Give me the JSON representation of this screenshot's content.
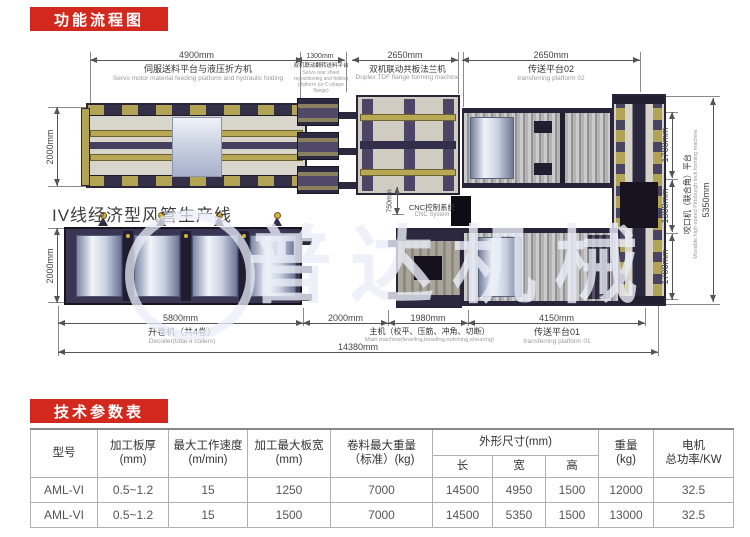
{
  "badges": {
    "flow_title": "功能流程图",
    "params_title": "技术参数表"
  },
  "colors": {
    "badge_red": "#d2281e"
  },
  "diagram": {
    "production_line_title": "IV线经济型风管生产线",
    "watermark_text": "普达机械",
    "cnc_label_zh": "CNC控制系统",
    "cnc_label_en": "CNC System",
    "dims": {
      "top_4900": "4900mm",
      "top_1300": "1300mm",
      "top_2650_a": "2650mm",
      "top_2650_b": "2650mm",
      "left_top": "2000mm",
      "left_bottom": "2000mm",
      "right_1700_a": "1700mm",
      "right_1300": "1300mm",
      "right_1700_b": "1700mm",
      "right_total": "5350mm",
      "cnc_750": "750mm",
      "bottom_5800": "5800mm",
      "bottom_2000": "2000mm",
      "bottom_1980": "1980mm",
      "bottom_4150": "4150mm",
      "bottom_total": "14380mm"
    },
    "labels": {
      "feeding_zh": "伺服送料平台与液压折方机",
      "feeding_en": "Servo motor material feeding platform and hydraulic folding",
      "turnover_zh": "双机联动翻转送料平台",
      "turnover_en": "Servo rear sheet repositioning and folding platform (or C-shape flange)",
      "tdf_zh": "双机联动共板法兰机",
      "tdf_en": "Duplex TDF flange forming machine",
      "platform02_zh": "传送平台02",
      "platform02_en": "transferring platform 02",
      "decoiler_zh": "开卷机（共4卷）",
      "decoiler_en": "Decoiler(total 4 coilers)",
      "main_zh": "主机（校平、压筋、冲角、切断）",
      "main_en": "Main machine(leveling,beading,notching,shearing)",
      "platform01_zh": "传送平台01",
      "platform01_en": "transferring platform 01",
      "lock_zh": "咬口机（联合角）平台",
      "lock_en": "Movable high-speed Pittsburgh lock forming machine"
    }
  },
  "table": {
    "headers": {
      "model_l1": "型号",
      "thickness_l1": "加工板厚",
      "thickness_l2": "(mm)",
      "speed_l1": "最大工作速度",
      "speed_l2": "(m/min)",
      "width_l1": "加工最大板宽",
      "width_l2": "(mm)",
      "coil_l1": "卷料最大重量",
      "coil_l2": "（标准）(kg)",
      "dims_group": "外形尺寸(mm)",
      "dim_l": "长",
      "dim_w": "宽",
      "dim_h": "高",
      "weight_l1": "重量",
      "weight_l2": "(kg)",
      "motor_l1": "电机",
      "motor_l2": "总功率/KW"
    },
    "rows": [
      [
        "AML-VI",
        "0.5~1.2",
        "15",
        "1250",
        "7000",
        "14500",
        "4950",
        "1500",
        "12000",
        "32.5"
      ],
      [
        "AML-VI",
        "0.5~1.2",
        "15",
        "1500",
        "7000",
        "14500",
        "5350",
        "1500",
        "13000",
        "32.5"
      ]
    ]
  }
}
